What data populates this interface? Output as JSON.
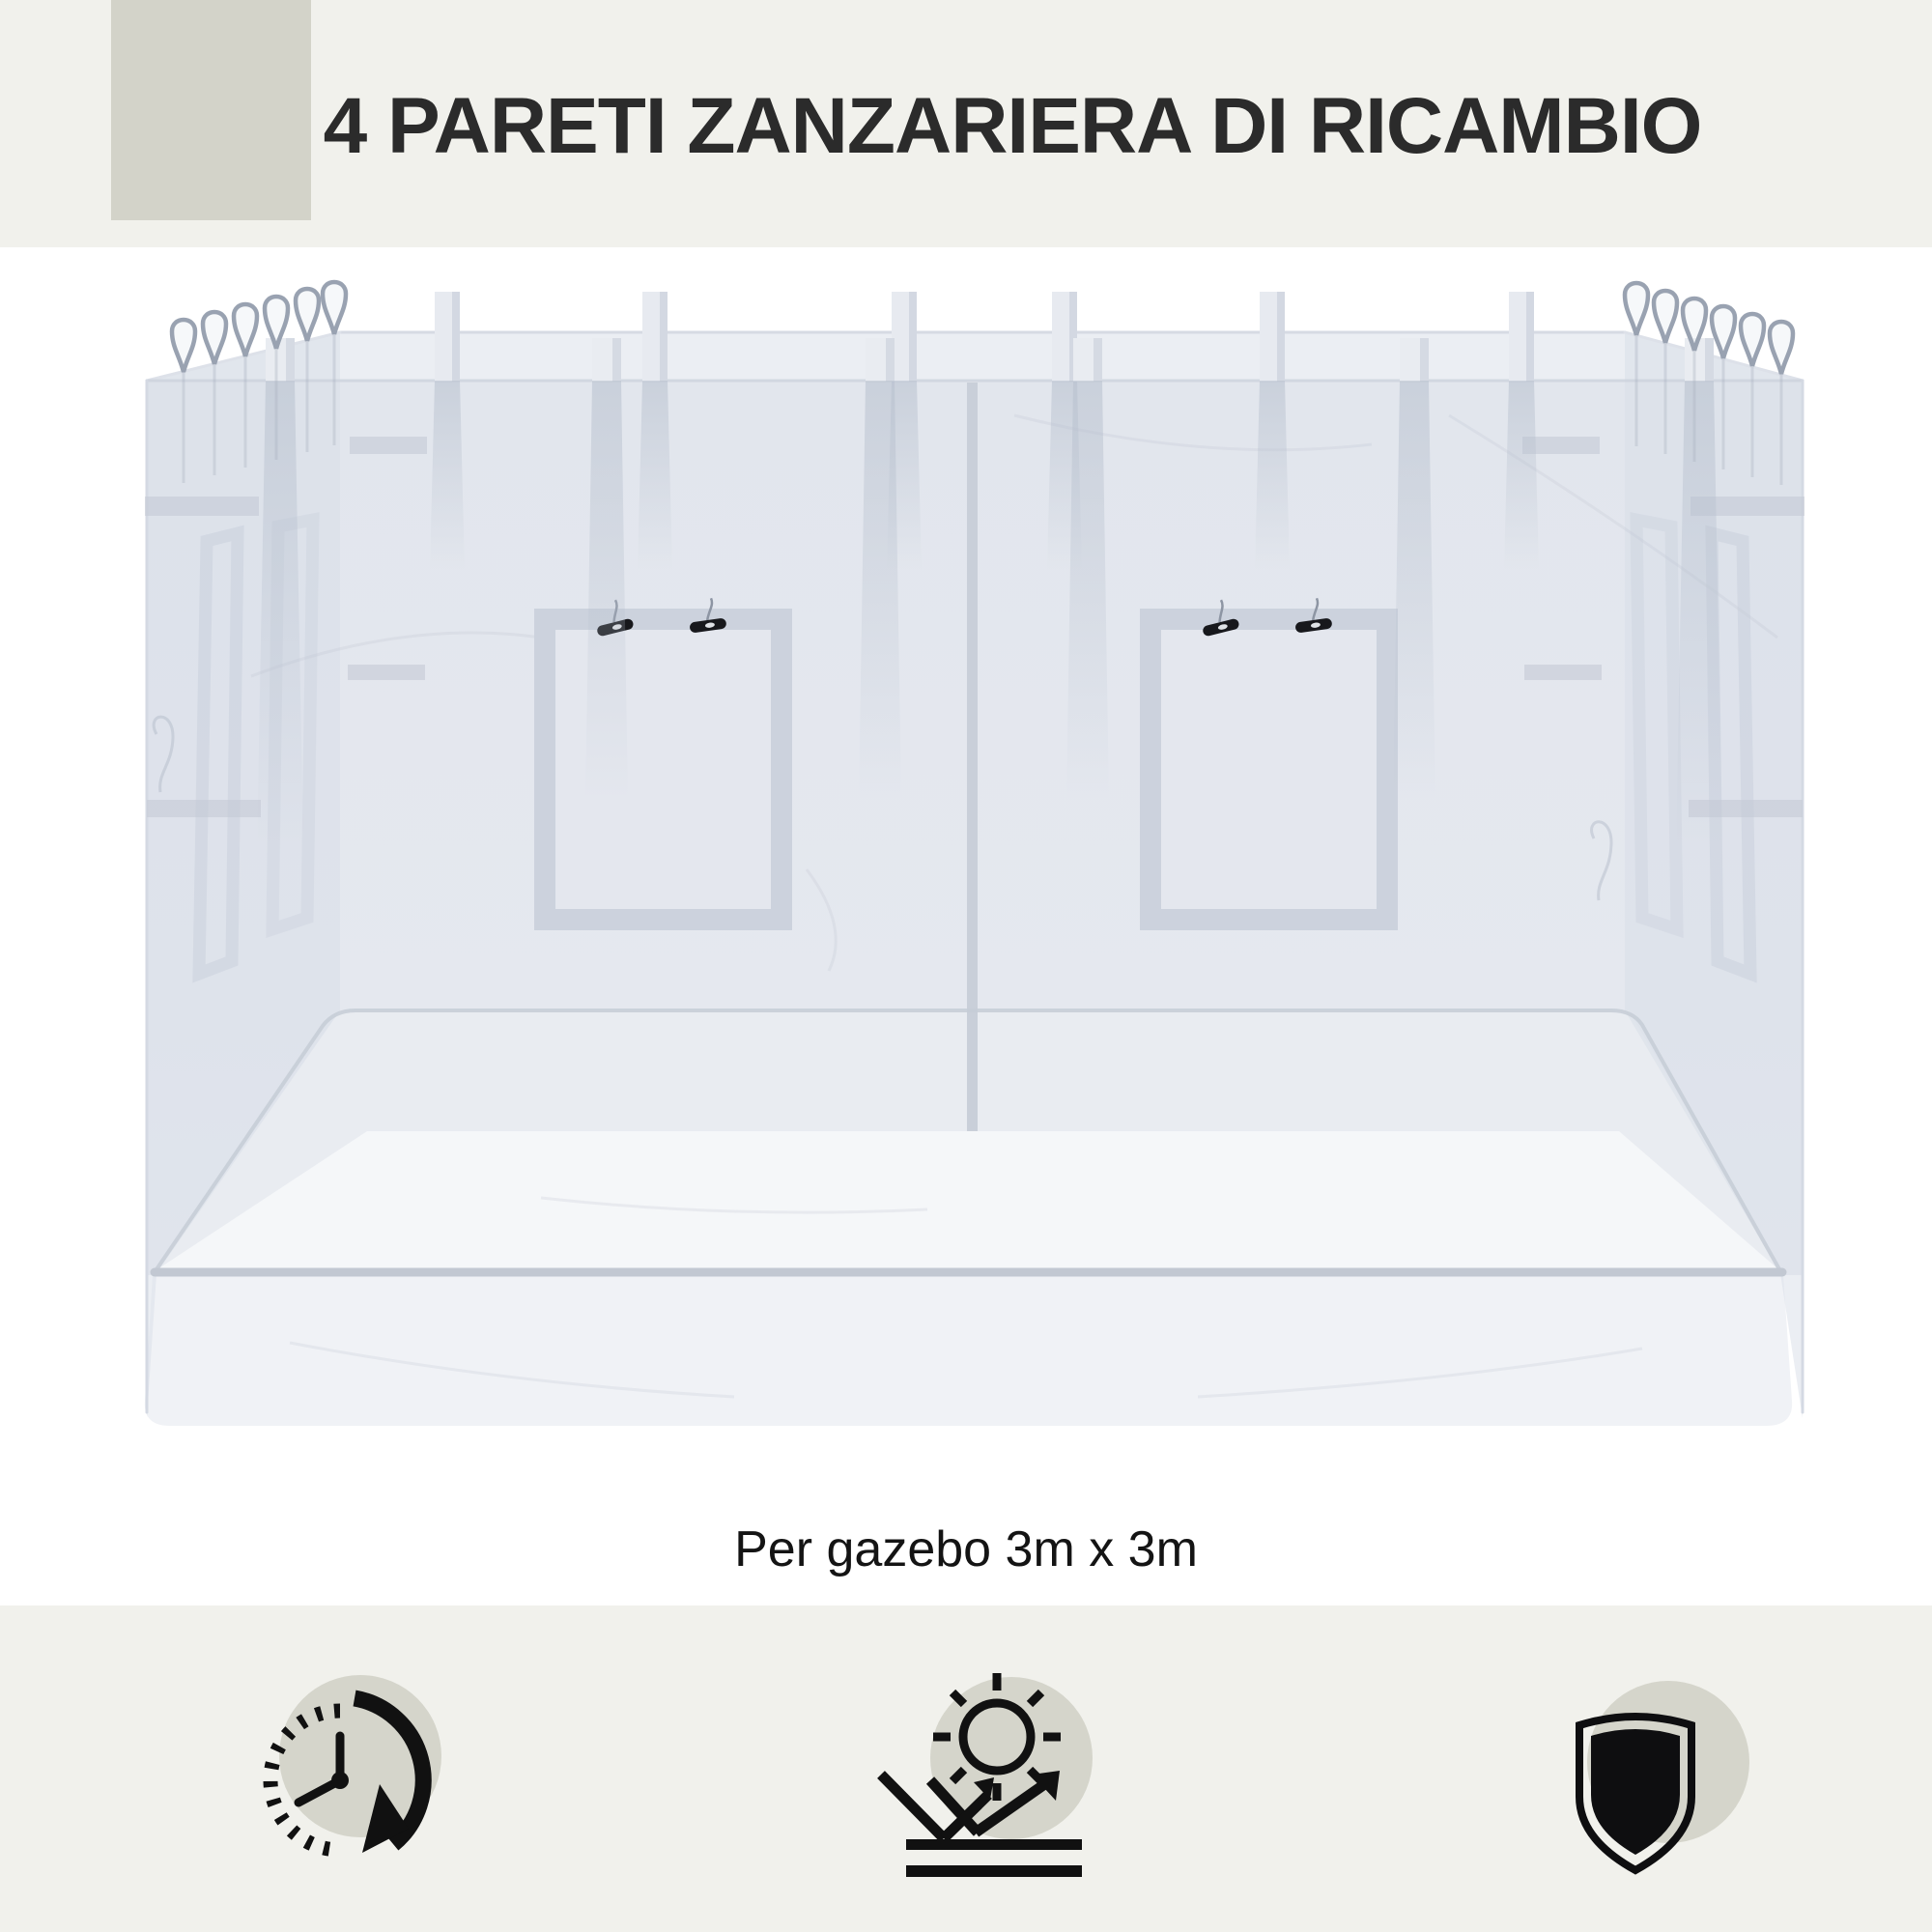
{
  "header": {
    "title": "4 PARETI ZANZARIERA DI RICAMBIO",
    "band_color": "#f1f1ec",
    "accent_square_color": "#d3d3c9",
    "title_color": "#2b2b2b"
  },
  "product": {
    "caption": "Per gazebo 3m x 3m",
    "illustration": "replacement-mosquito-net-walls",
    "net_color": "#e3e7ee",
    "frame_color": "#ccd2dd",
    "clip_color": "#17181c"
  },
  "footer": {
    "band_color": "#f1f1ec",
    "icon_color": "#111111",
    "icon_circle_color": "#d5d5cb",
    "icons": [
      {
        "name": "clock-timer-icon"
      },
      {
        "name": "uv-reflection-sun-icon"
      },
      {
        "name": "shield-icon"
      }
    ]
  }
}
